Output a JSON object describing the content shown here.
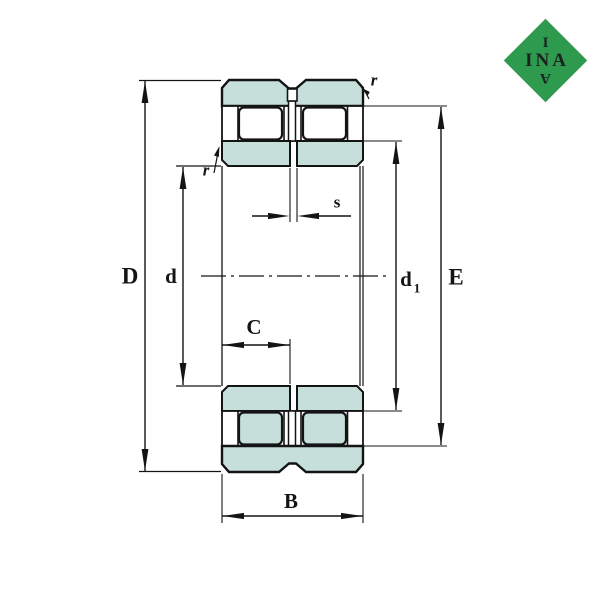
{
  "drawing": {
    "labels": {
      "D": "D",
      "d": "d",
      "B": "B",
      "C": "C",
      "E": "E",
      "s": "s",
      "r_outer": "r",
      "r_inner": "r",
      "d1_base": "d",
      "d1_sub": "1"
    },
    "colors": {
      "background": "#ffffff",
      "section_fill": "#c6dfda",
      "line": "#141414",
      "logo_green": "#2e9a4d",
      "logo_text": "#1c2220"
    },
    "logo": {
      "row1": "I",
      "row2": "INA",
      "row3": "A"
    }
  }
}
